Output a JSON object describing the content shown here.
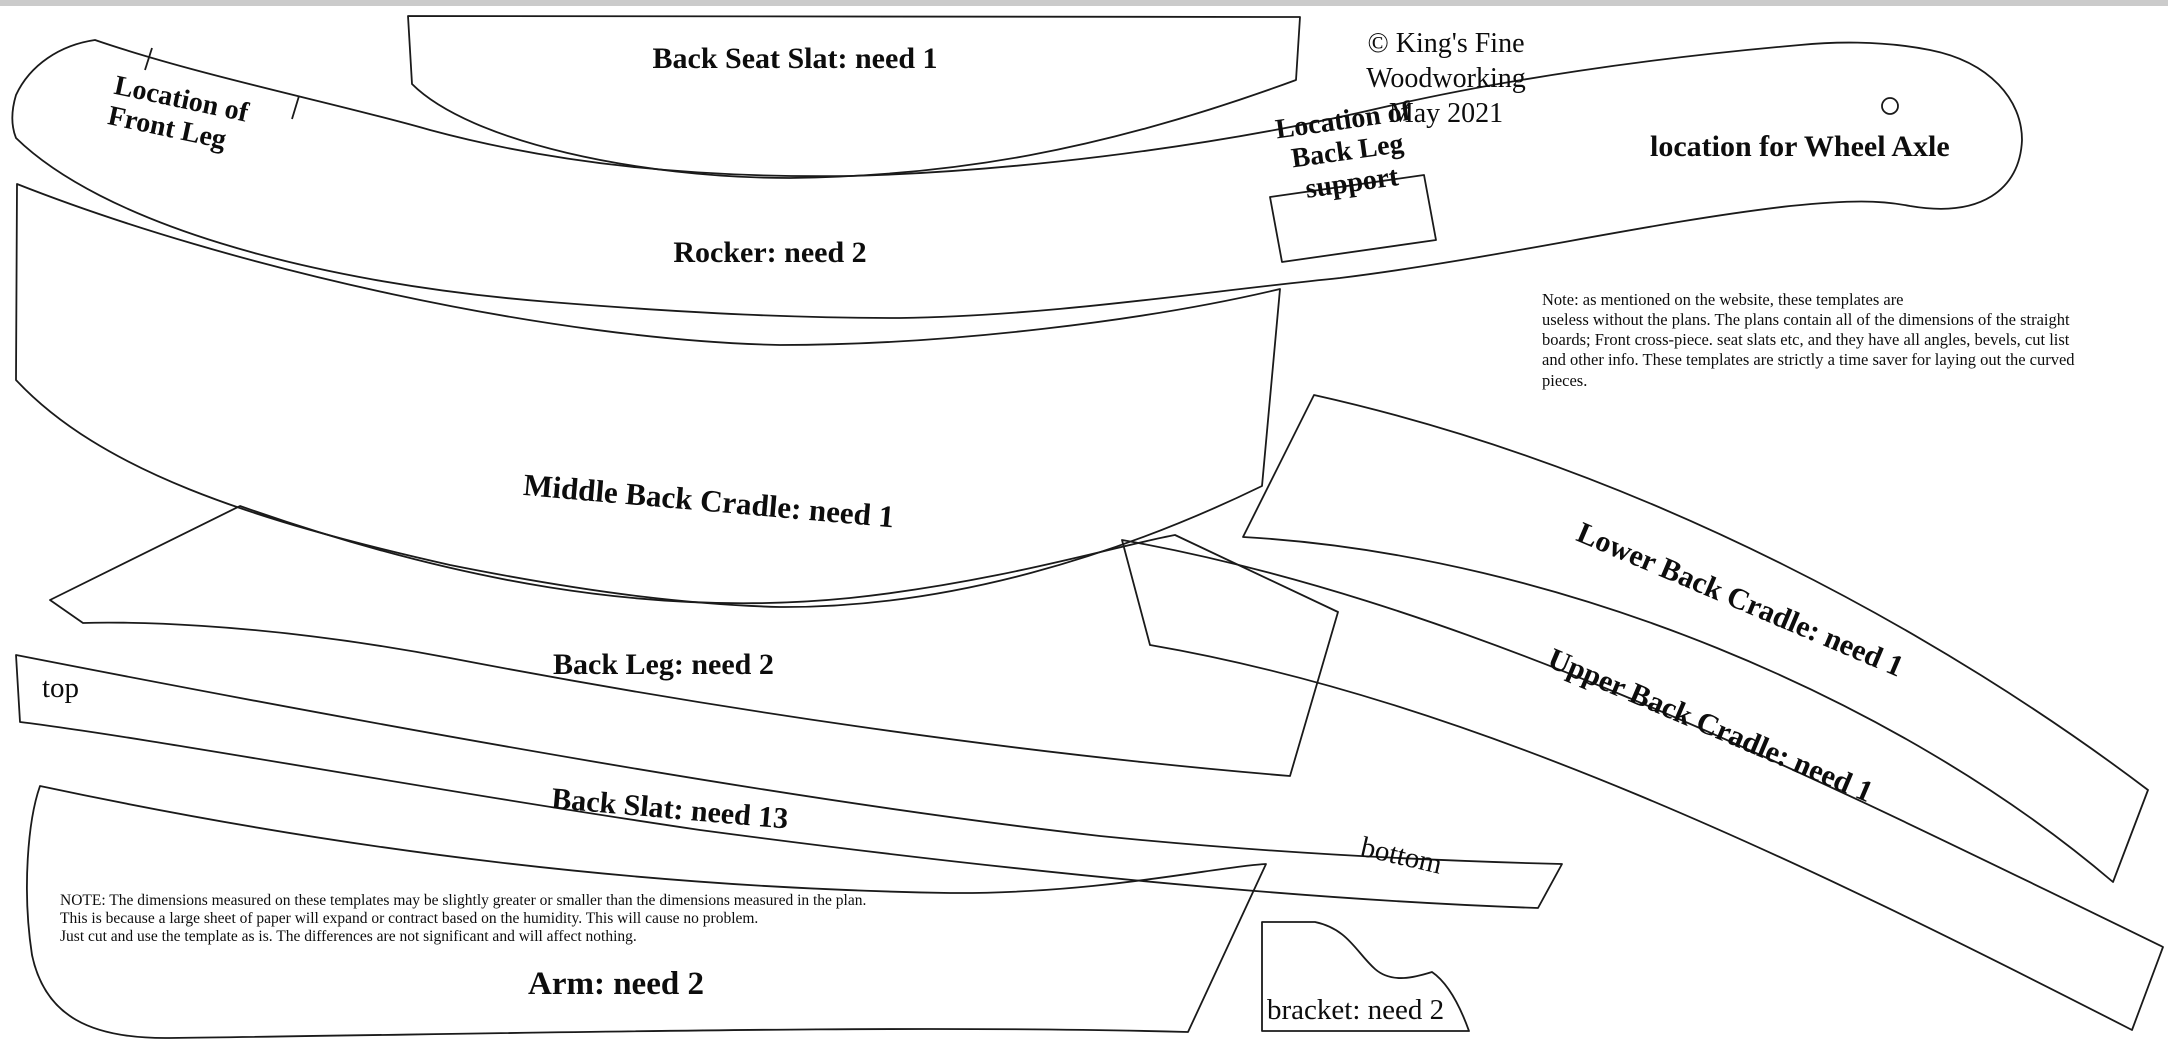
{
  "colors": {
    "line": "#1a1a1a",
    "text": "#0d0d0d",
    "top_bar": "#cbcbcb",
    "background": "#ffffff"
  },
  "header": {
    "copyright": "© King's Fine Woodworking",
    "date": "May 2021"
  },
  "pieces": {
    "back_seat_slat": {
      "label": "Back Seat Slat: need 1"
    },
    "rocker": {
      "label": "Rocker: need 2",
      "front_leg_location": "Location of\nFront Leg",
      "back_leg_support_location": "Location of\nBack Leg support",
      "wheel_axle_location": "location for Wheel Axle"
    },
    "middle_back_cradle": {
      "label": "Middle Back Cradle: need 1"
    },
    "back_leg": {
      "label": "Back Leg: need 2"
    },
    "back_slat": {
      "label": "Back Slat: need 13",
      "top_end_label": "top",
      "bottom_end_label": "bottom"
    },
    "arm": {
      "label": "Arm: need 2"
    },
    "bracket": {
      "label": "bracket: need 2"
    },
    "lower_back_cradle": {
      "label": "Lower Back Cradle: need 1"
    },
    "upper_back_cradle": {
      "label": "Upper Back Cradle: need 1"
    }
  },
  "notes": {
    "plans_note": "Note: as mentioned on the website, these templates are\nuseless without the plans. The plans contain all of the dimensions of the straight\nboards;  Front cross-piece. seat slats etc, and they have all angles, bevels, cut list\nand other info. These templates are strictly a time saver for laying out the curved\npieces.",
    "humidity_note": "NOTE: The dimensions measured on these templates may be slightly greater or smaller than the dimensions measured in the plan.\nThis is because a large sheet of paper will expand or contract based on the humidity. This will cause no problem.\nJust cut and use the template as is. The differences are not significant and will affect nothing."
  }
}
